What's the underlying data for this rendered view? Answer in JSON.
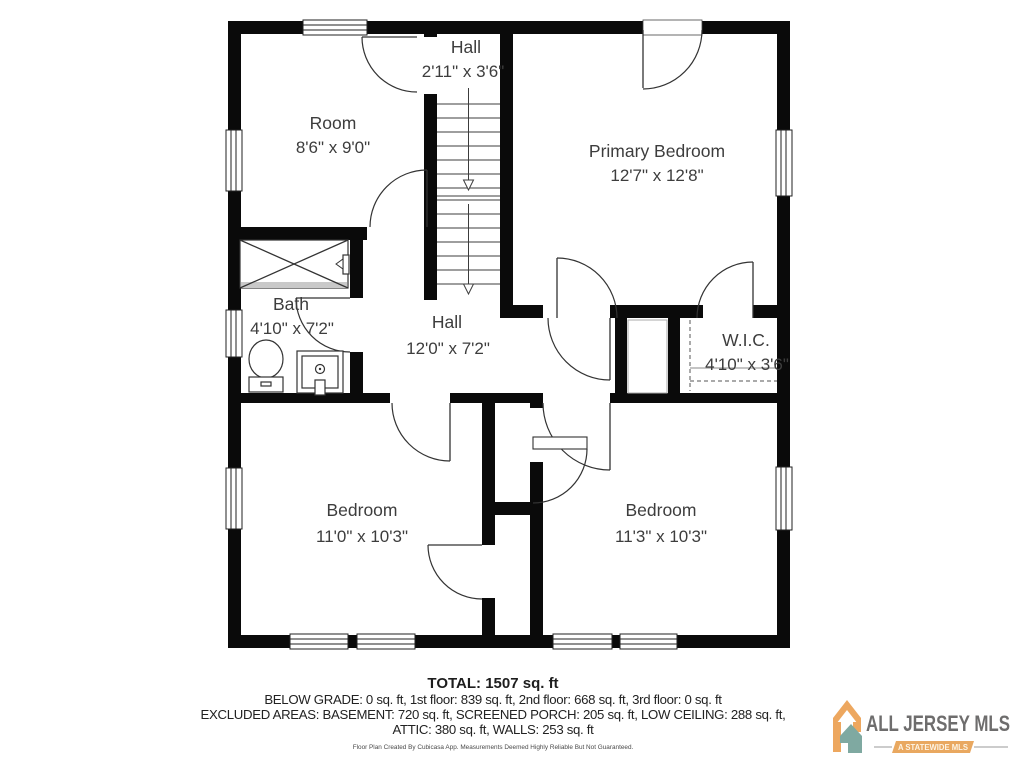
{
  "floor_plan": {
    "rooms": [
      {
        "name": "Room",
        "dims": "8'6\" x 9'0\""
      },
      {
        "name": "Hall",
        "dims": "2'11\" x 3'6\""
      },
      {
        "name": "Primary Bedroom",
        "dims": "12'7\" x 12'8\""
      },
      {
        "name": "Bath",
        "dims": "4'10\" x 7'2\""
      },
      {
        "name": "Hall",
        "dims": "12'0\" x 7'2\""
      },
      {
        "name": "W.I.C.",
        "dims": "4'10\" x 3'6\""
      },
      {
        "name": "Bedroom",
        "dims": "11'0\" x 10'3\""
      },
      {
        "name": "Bedroom",
        "dims": "11'3\" x 10'3\""
      }
    ],
    "wall_color": "#0a0a0a"
  },
  "summary": {
    "total": "TOTAL: 1507 sq. ft",
    "line1": "BELOW GRADE: 0 sq. ft, 1st floor: 839 sq. ft, 2nd floor: 668 sq. ft, 3rd floor: 0 sq. ft",
    "line2": "EXCLUDED AREAS: BASEMENT: 720 sq. ft, SCREENED PORCH: 205 sq. ft, LOW CEILING: 288 sq. ft,",
    "line3": "ATTIC: 380 sq. ft, WALLS: 253 sq. ft",
    "disclaimer": "Floor Plan Created By Cubicasa App. Measurements Deemed Highly Reliable But Not Guaranteed."
  },
  "logo": {
    "title": "ALL JERSEY MLS",
    "subtitle": "A STATEWIDE MLS",
    "colors": {
      "orange": "#eda75f",
      "teal": "#7fa9a1",
      "gray": "#6e6d6d"
    }
  }
}
